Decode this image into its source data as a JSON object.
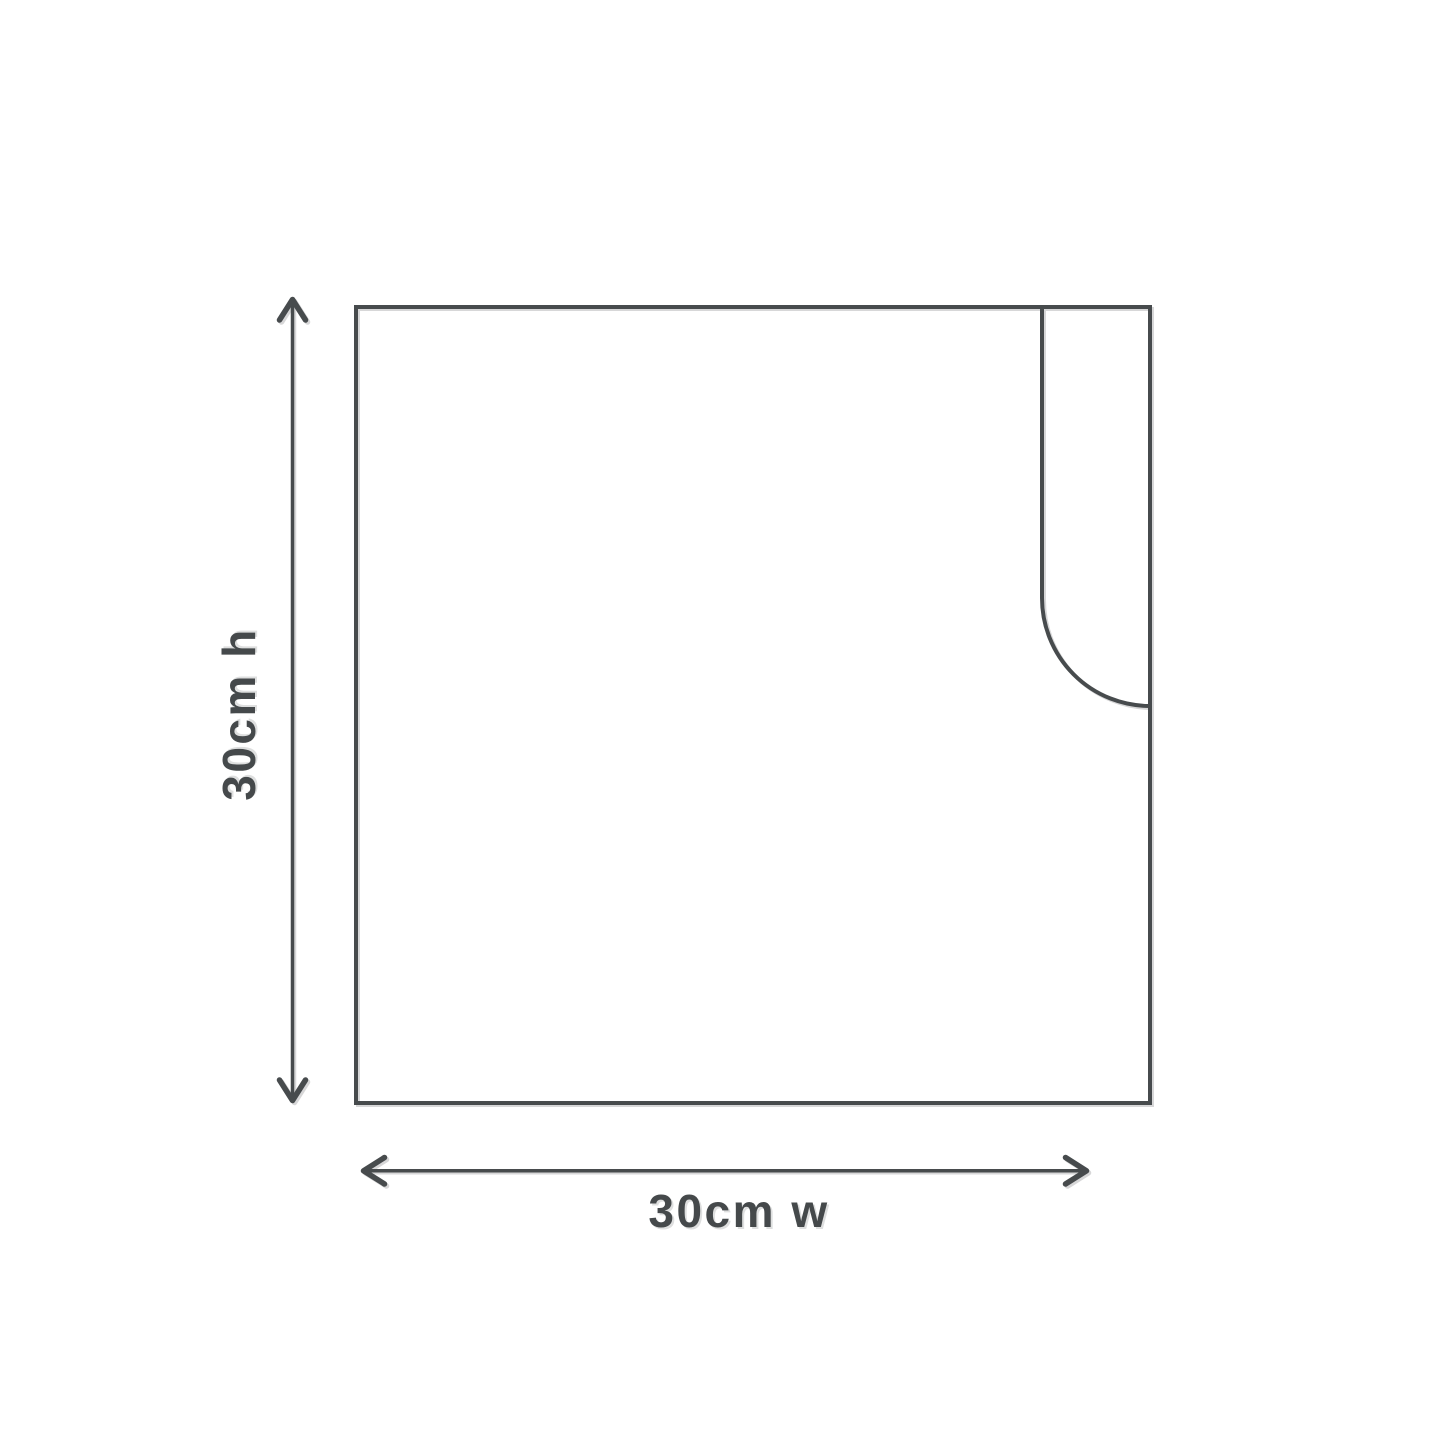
{
  "figure": {
    "type": "product-dimension-diagram",
    "subject": "square-sleeve-with-thumb-cutout",
    "height_label": "30cm h",
    "width_label": "30cm w",
    "dimensions": {
      "height": "30cm",
      "width": "30cm"
    },
    "colors": {
      "line": "#474b4d",
      "text": "#45494b",
      "background": "#ffffff"
    }
  }
}
